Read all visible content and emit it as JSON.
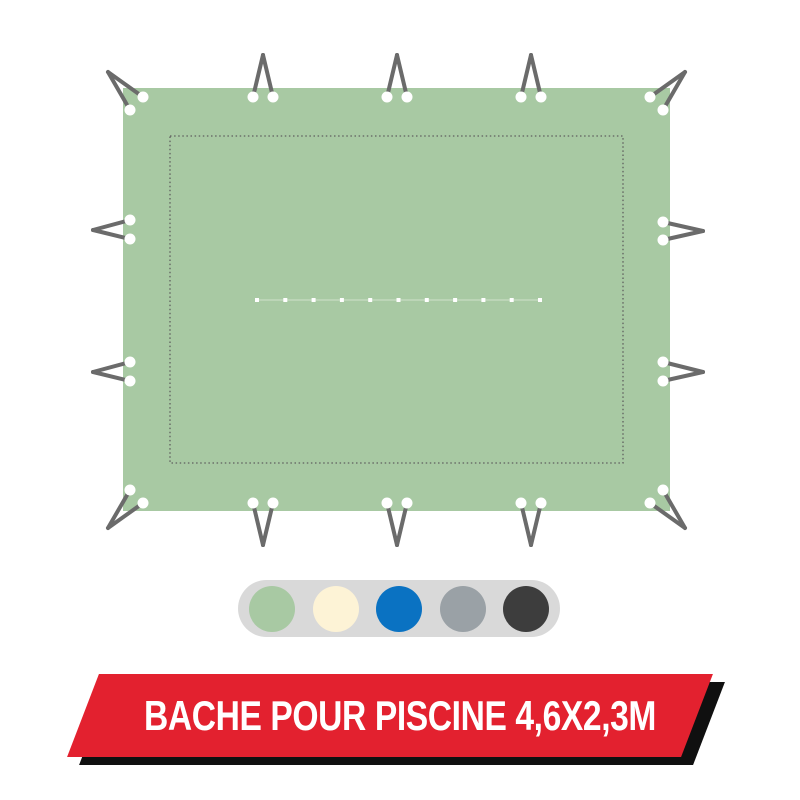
{
  "banner": {
    "label": "BACHE POUR PISCINE 4,6X2,3M"
  },
  "colors": {
    "background": "#ffffff",
    "tarp": "#a8c9a3",
    "stitch": "#5e5e5e",
    "cord": "#6b6b6b",
    "eyelet": "#ffffff",
    "swatch_track": "#d9d9d9",
    "banner_red": "#e3212f",
    "banner_shadow": "#101010",
    "banner_text": "#ffffff"
  },
  "swatches": [
    {
      "name": "green",
      "hex": "#a8c9a3"
    },
    {
      "name": "cream",
      "hex": "#fdf3d6"
    },
    {
      "name": "blue",
      "hex": "#0a72c2"
    },
    {
      "name": "gray",
      "hex": "#9aa1a6"
    },
    {
      "name": "charcoal",
      "hex": "#3d3d3d"
    }
  ]
}
